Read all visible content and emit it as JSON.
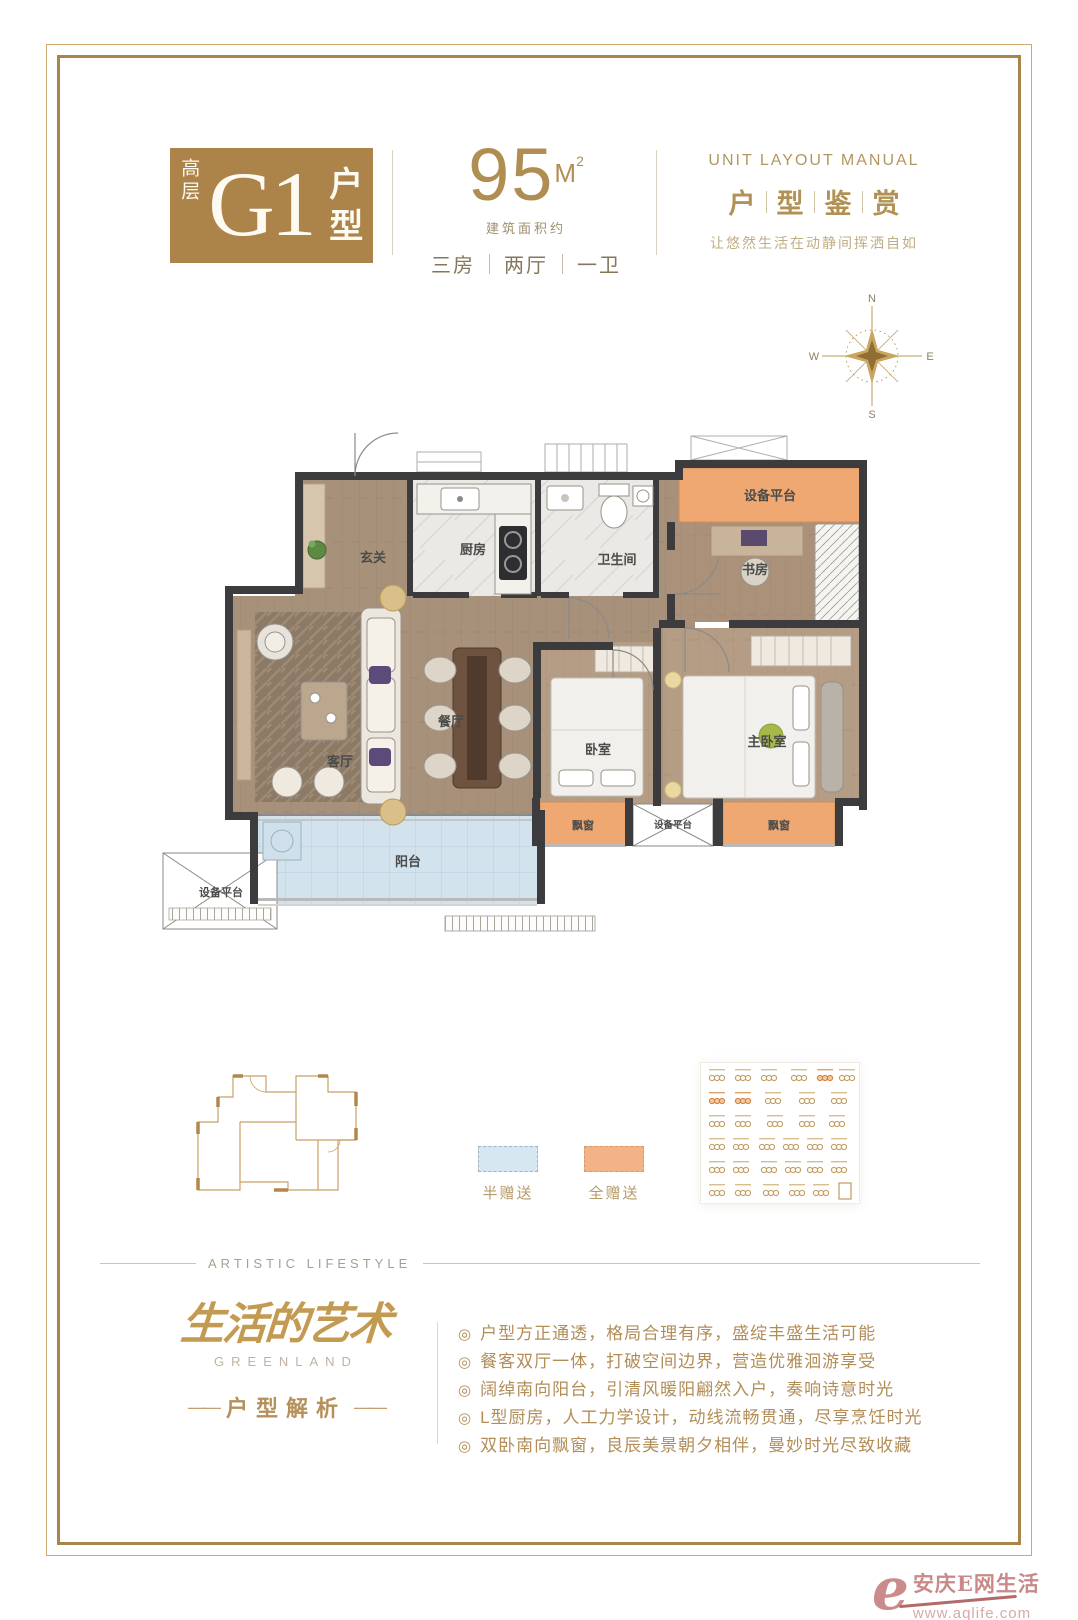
{
  "badge": {
    "tier": "高层",
    "code": "G1",
    "suffix": "户型"
  },
  "area": {
    "value": "95",
    "unit": "M",
    "sup": "2",
    "approx": "建筑面积约",
    "specs": [
      "三房",
      "两厅",
      "一卫"
    ]
  },
  "manual": {
    "en": "UNIT LAYOUT MANUAL",
    "chars": [
      "户",
      "型",
      "鉴",
      "赏"
    ],
    "tagline": "让悠然生活在动静间挥洒自如"
  },
  "compass": {
    "n": "N",
    "e": "E",
    "s": "S",
    "w": "W"
  },
  "plan": {
    "entry": "玄关",
    "kitchen": "厨房",
    "bath": "卫生间",
    "study": "书房",
    "equip": "设备平台",
    "dining": "餐厅",
    "living": "客厅",
    "bedroom": "卧室",
    "master": "主卧室",
    "bay": "飘窗",
    "balcony": "阳台"
  },
  "legend": {
    "half": "半赠送",
    "full": "全赠送"
  },
  "artistic": "ARTISTIC  LIFESTYLE",
  "brand": {
    "cn": "生活的艺术",
    "en": "GREENLAND",
    "section": "户型解析",
    "dash": "——"
  },
  "bullet": "◎",
  "features": [
    "户型方正通透，格局合理有序，盛绽丰盛生活可能",
    "餐客双厅一体，打破空间边界，营造优雅洄游享受",
    "阔绰南向阳台，引清风暖阳翩然入户，奏响诗意时光",
    "L型厨房，人工力学设计，动线流畅贯通，尽享烹饪时光",
    "双卧南向飘窗，良辰美景朝夕相伴，曼妙时光尽致收藏"
  ],
  "watermark": {
    "mark": "e",
    "name": "安庆E网生活",
    "url": "www.aqlife.com"
  },
  "colors": {
    "badge_gold": "#ac8348",
    "text_gold": "#b28d58",
    "frame_gold": "#a8854c",
    "gift_full_orange": "#f0a873",
    "gift_half_blue": "#d6e7f2",
    "wall_dark": "#3c3c3e",
    "watermark_rose": "#cc8b8b"
  }
}
